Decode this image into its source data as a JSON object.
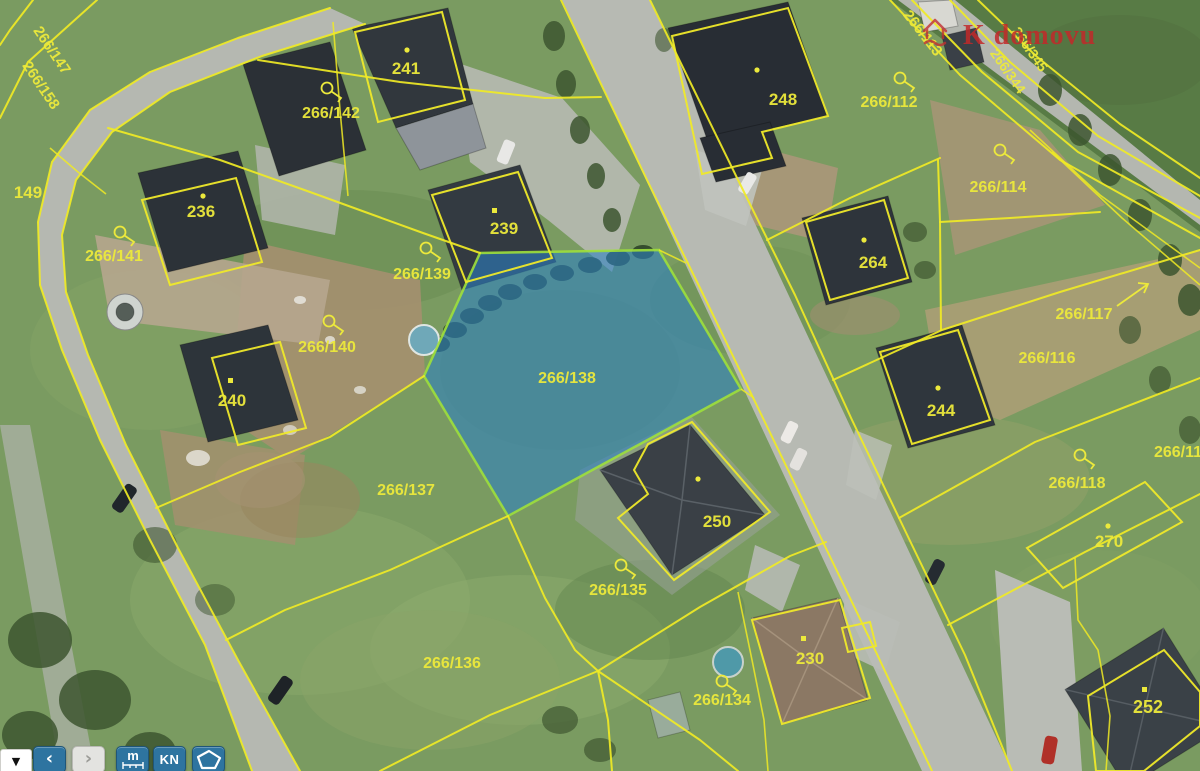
{
  "map": {
    "street_name": "K domovu",
    "selected_parcel": "266/138",
    "colors": {
      "parcel_line": "#f0ea25",
      "parcel_label": "#ece93c",
      "highlight_fill": "#2b7fc4",
      "highlight_border": "#9fe03b",
      "street_name_red": "#c22a2a",
      "toolbar_button_blue": "#2e74a0"
    },
    "labels": [
      {
        "text": "266/147"
      },
      {
        "text": "266/158"
      },
      {
        "text": "149"
      },
      {
        "text": "266/142"
      },
      {
        "text": "241"
      },
      {
        "text": "266/141"
      },
      {
        "text": "236"
      },
      {
        "text": "266/139"
      },
      {
        "text": "239"
      },
      {
        "text": "266/140"
      },
      {
        "text": "240"
      },
      {
        "text": "266/137"
      },
      {
        "text": "266/138"
      },
      {
        "text": "266/135"
      },
      {
        "text": "266/136"
      },
      {
        "text": "266/134"
      },
      {
        "text": "230"
      },
      {
        "text": "250"
      },
      {
        "text": "248"
      },
      {
        "text": "266/112"
      },
      {
        "text": "266/113"
      },
      {
        "text": "264"
      },
      {
        "text": "266/114"
      },
      {
        "text": "266/117"
      },
      {
        "text": "266/116"
      },
      {
        "text": "266/118"
      },
      {
        "text": "270"
      },
      {
        "text": "244"
      },
      {
        "text": "252"
      },
      {
        "text": "266/11"
      },
      {
        "text": "266/345"
      },
      {
        "text": "266/344"
      }
    ]
  },
  "toolbar": {
    "layers_dropdown_symbol": "▼",
    "back_symbol": "‹",
    "forward_symbol": "›",
    "measure_label": "m",
    "cadastre_label": "KN"
  }
}
